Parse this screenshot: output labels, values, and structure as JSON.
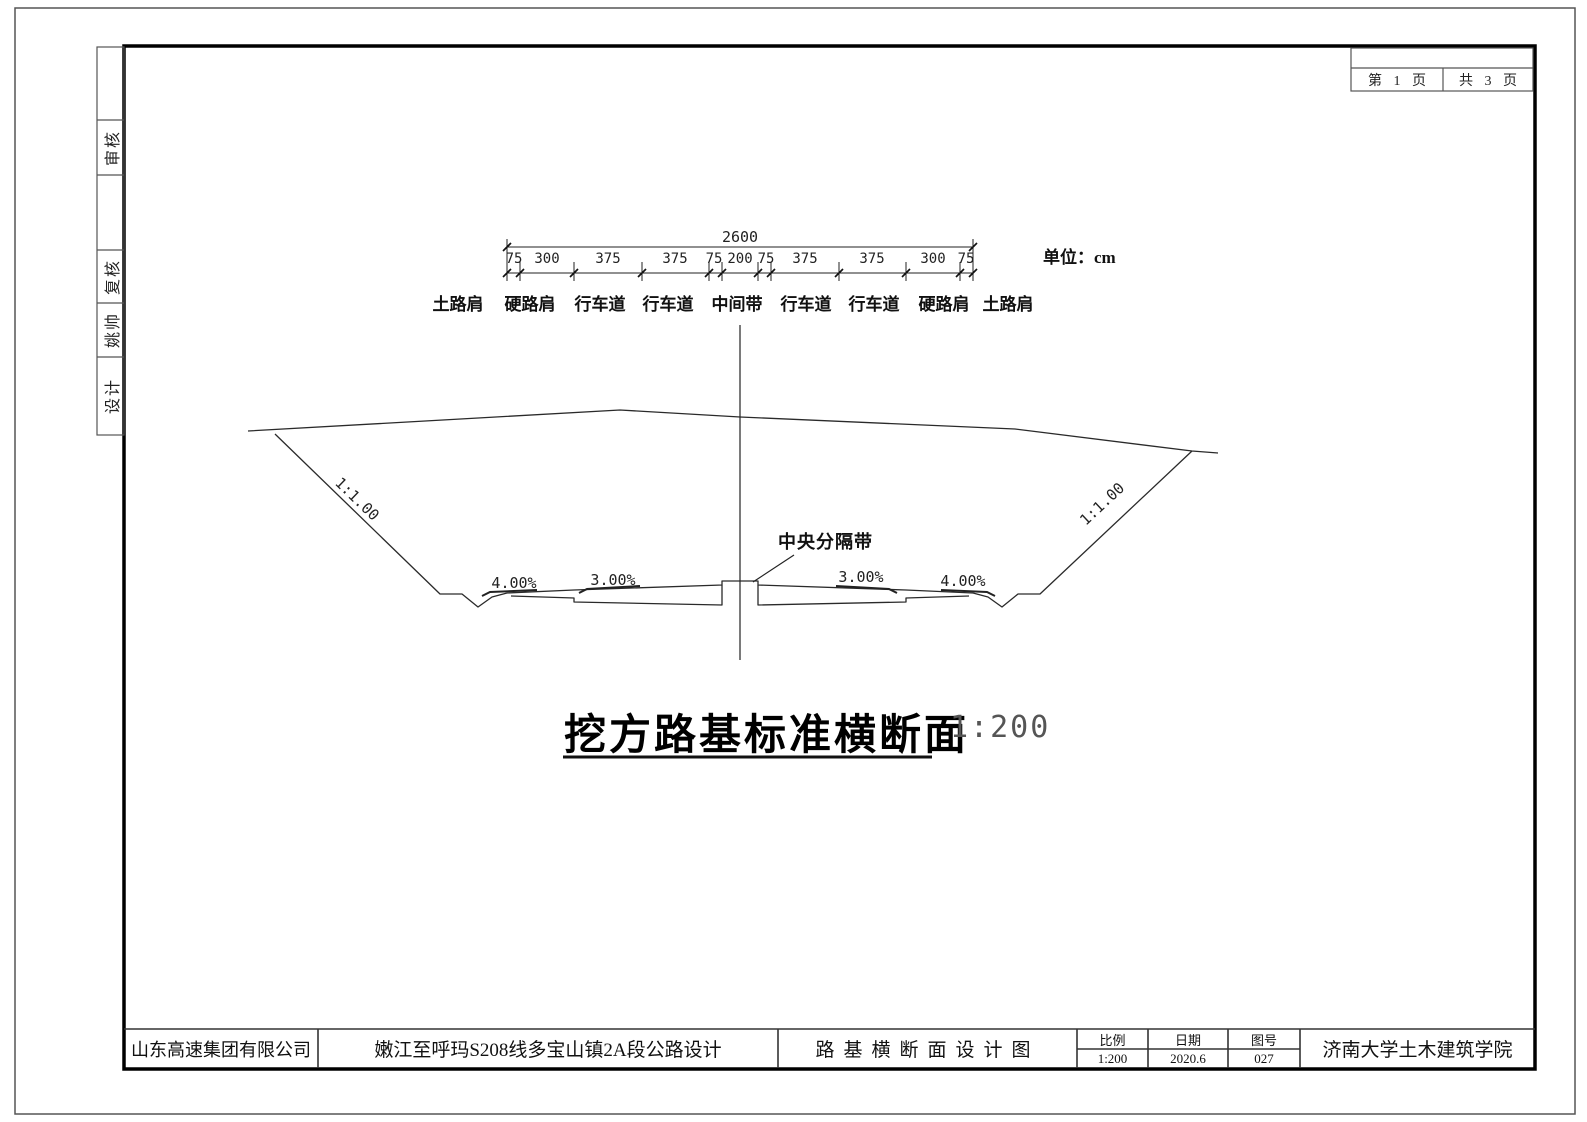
{
  "page_box": {
    "current": "第 1 页",
    "total": "共 3 页"
  },
  "side_strip": {
    "cells": [
      {
        "label": ""
      },
      {
        "label": "审核"
      },
      {
        "label": ""
      },
      {
        "label": "复核"
      },
      {
        "label": "姚帅"
      },
      {
        "label": "设计"
      }
    ]
  },
  "dimensions": {
    "total": "2600",
    "unit_note": "单位：cm",
    "segments": [
      "75",
      "300",
      "375",
      "375",
      "75",
      "200",
      "75",
      "375",
      "375",
      "300",
      "75"
    ],
    "labels": [
      "土路肩",
      "硬路肩",
      "行车道",
      "行车道",
      "中间带",
      "行车道",
      "行车道",
      "硬路肩",
      "土路肩"
    ]
  },
  "section": {
    "median_label": "中央分隔带",
    "slope_left": "1:1.00",
    "slope_right": "1:1.00",
    "crossfall": [
      "4.00%",
      "3.00%",
      "3.00%",
      "4.00%"
    ]
  },
  "title": {
    "text": "挖方路基标准横断面",
    "scale": "1:200"
  },
  "title_block": {
    "company": "山东高速集团有限公司",
    "project": "嫩江至呼玛S208线多宝山镇2A段公路设计",
    "drawing_title": "路基横断面设计图",
    "scale_label": "比例",
    "scale_value": "1:200",
    "date_label": "日期",
    "date_value": "2020.6",
    "number_label": "图号",
    "number_value": "027",
    "institute": "济南大学土木建筑学院"
  },
  "colors": {
    "line": "#2a2a2a",
    "frame": "#000000"
  }
}
